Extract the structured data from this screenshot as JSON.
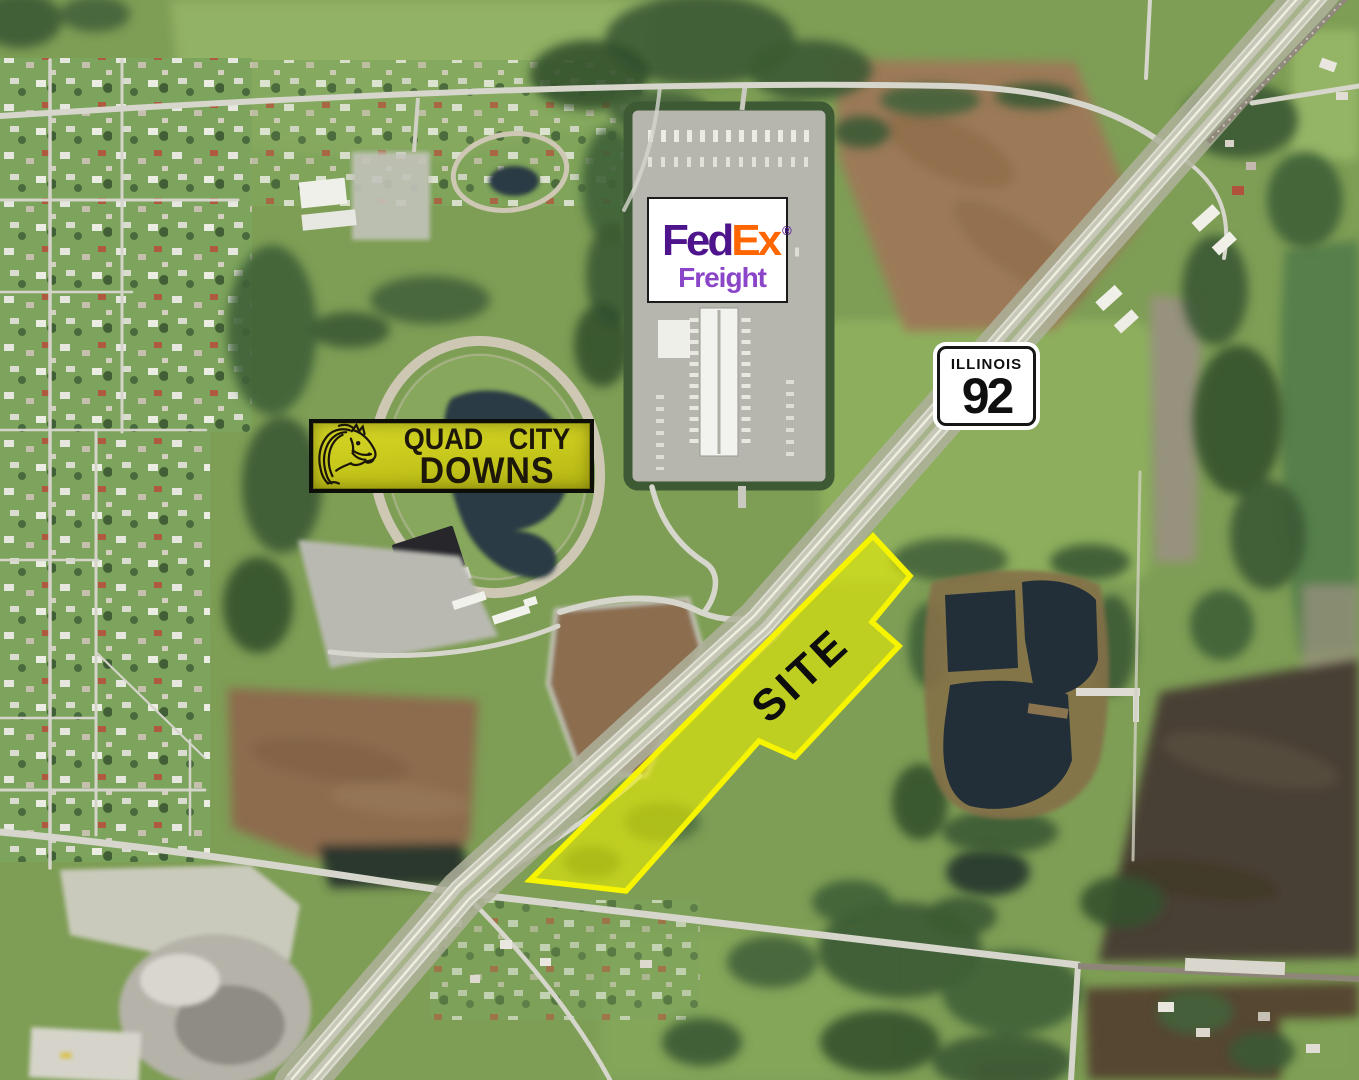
{
  "annotations": {
    "fedex": {
      "name": "FedEx Freight logo",
      "fed": "Fed",
      "ex": "Ex",
      "registered": "®",
      "freight": "Freight",
      "fed_color": "#4D148C",
      "ex_color": "#FF6600",
      "freight_color": "#8B45C9"
    },
    "route_shield": {
      "state": "ILLINOIS",
      "number": "92"
    },
    "racetrack_sign": {
      "line1": "QUAD CITY",
      "line2": "DOWNS",
      "icon": "horse-head-icon",
      "bg_color": "#C9CA1D",
      "text_color": "#1C1708"
    },
    "site": {
      "label": "SITE",
      "polygon_points": "873,536 910,576 872,622 899,646 795,757 759,741 626,891 530,880",
      "outline_color": "#F7F400",
      "fill_color": "rgba(235,240,0,0.6)"
    }
  }
}
